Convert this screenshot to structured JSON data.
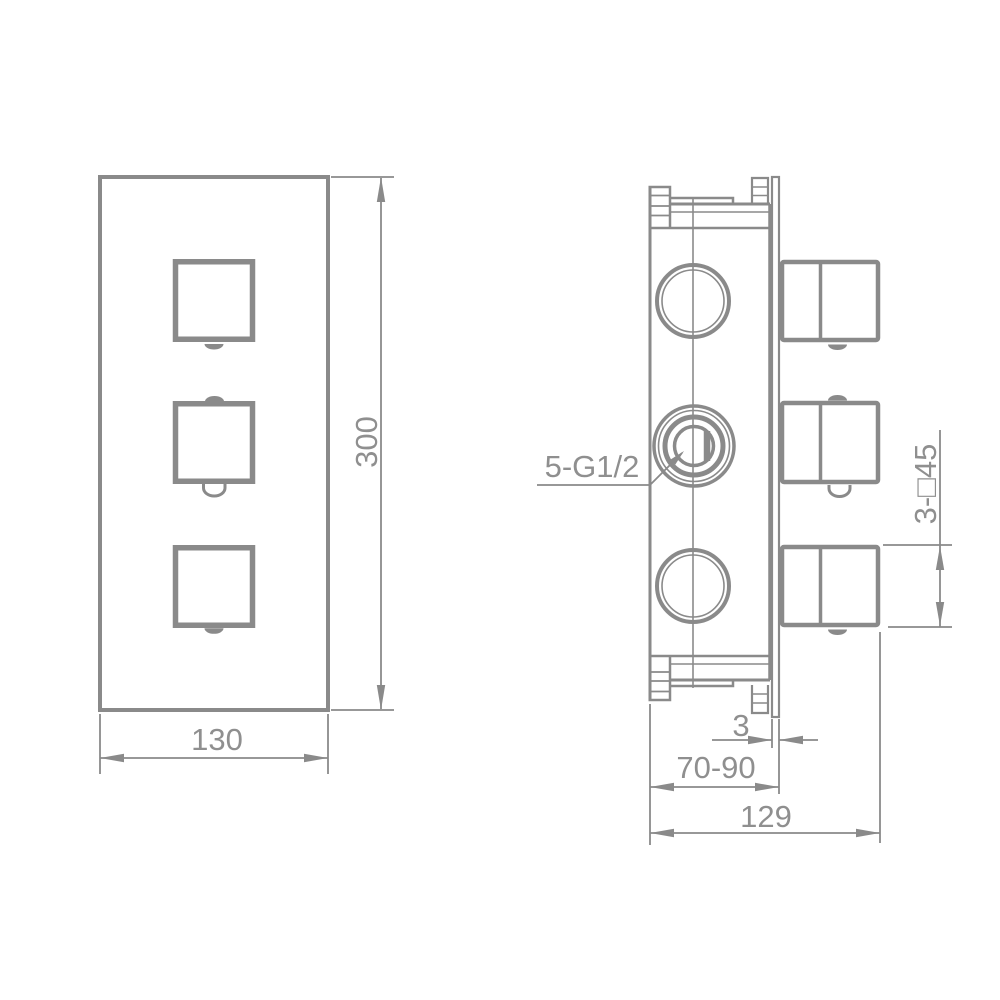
{
  "drawing": {
    "type": "technical dimensional drawing",
    "subject": "3-handle concealed thermostatic shower valve - front view and side view",
    "colors": {
      "line": "#8a8a8a",
      "text": "#8f8f8f",
      "background": "#ffffff"
    },
    "front_view": {
      "width_dim": "130",
      "height_dim": "300"
    },
    "side_view": {
      "ports_label": "5-G1/2",
      "handles_label": "3-□45",
      "plate_thickness_dim": "3",
      "mounting_depth_dim": "70-90",
      "overall_depth_dim": "129"
    }
  }
}
